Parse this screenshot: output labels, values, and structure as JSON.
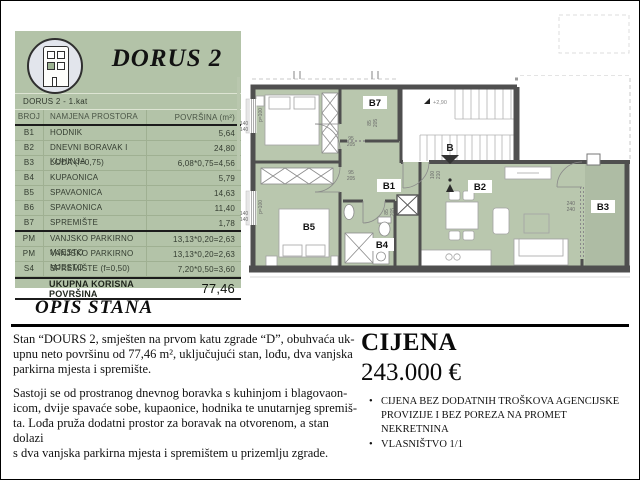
{
  "header": {
    "title": "DORUS 2",
    "subtitle": "DORUS 2 - 1.kat"
  },
  "table": {
    "columns": {
      "id": "BROJ",
      "name": "NAMJENA PROSTORA",
      "area": "POVRŠINA (m²)"
    },
    "rows": [
      {
        "id": "B1",
        "name": "HODNIK",
        "area": "5,64"
      },
      {
        "id": "B2",
        "name": "DNEVNI BORAVAK I KUHINJA",
        "area": "24,80"
      },
      {
        "id": "B3",
        "name": "LOĐA (f=0,75)",
        "area": "6,08*0,75=4,56"
      },
      {
        "id": "B4",
        "name": "KUPAONICA",
        "area": "5,79"
      },
      {
        "id": "B5",
        "name": "SPAVAONICA",
        "area": "14,63"
      },
      {
        "id": "B6",
        "name": "SPAVAONICA",
        "area": "11,40"
      },
      {
        "id": "B7",
        "name": "SPREMIŠTE",
        "area": "1,78"
      },
      {
        "id": "PM",
        "name": "VANJSKO PARKIRNO MJESTO",
        "area": "13,13*0,20=2,63"
      },
      {
        "id": "PM",
        "name": "VANJSKO PARKIRNO MJESTO",
        "area": "13,13*0,20=2,63"
      },
      {
        "id": "S4",
        "name": "SPREMIŠTE (f=0,50)",
        "area": "7,20*0,50=3,60"
      }
    ],
    "total": {
      "label": "UKUPNA KORISNA POVRŠINA",
      "value": "77,46"
    }
  },
  "plan": {
    "rooms": {
      "b1": "B1",
      "b2": "B2",
      "b3": "B3",
      "b4": "B4",
      "b5": "B5",
      "b7": "B7"
    },
    "stair_label": "B",
    "level": "+2,90",
    "dims": {
      "d95": "95",
      "d205": "205",
      "d85": "85",
      "d100": "100",
      "d210": "210",
      "d240": "240",
      "d140": "140",
      "p100": "p=100"
    }
  },
  "opis": {
    "title": "OPIS STANA",
    "p1": "Stan “DOURS 2, smješten na prvom katu zgrade “D”, obuhvaća uk-\nupnu neto površinu od 77,46 m², uključujući stan, lođu, dva vanjska\nparkirna mjesta i spremište.",
    "p2": "Sastoji se od prostranog dnevnog boravka s kuhinjom i blagovaon-\nicom, dvije spavaće sobe, kupaonice, hodnika te unutarnjeg spremiš-\nta. Lođa pruža dodatni prostor za boravak na otvorenom, a stan dolazi\ns dva vanjska parkirna mjesta i spremištem u prizemlju zgrade."
  },
  "cijena": {
    "title": "CIJENA",
    "price": "243.000 €",
    "bullets": [
      "CIJENA BEZ DODATNIH TROŠKOVA AGENCIJSKE PROVIZIJE I BEZ POREZA NA PROMET NEKRETNINA",
      "VLASNIŠTVO 1/1"
    ]
  }
}
